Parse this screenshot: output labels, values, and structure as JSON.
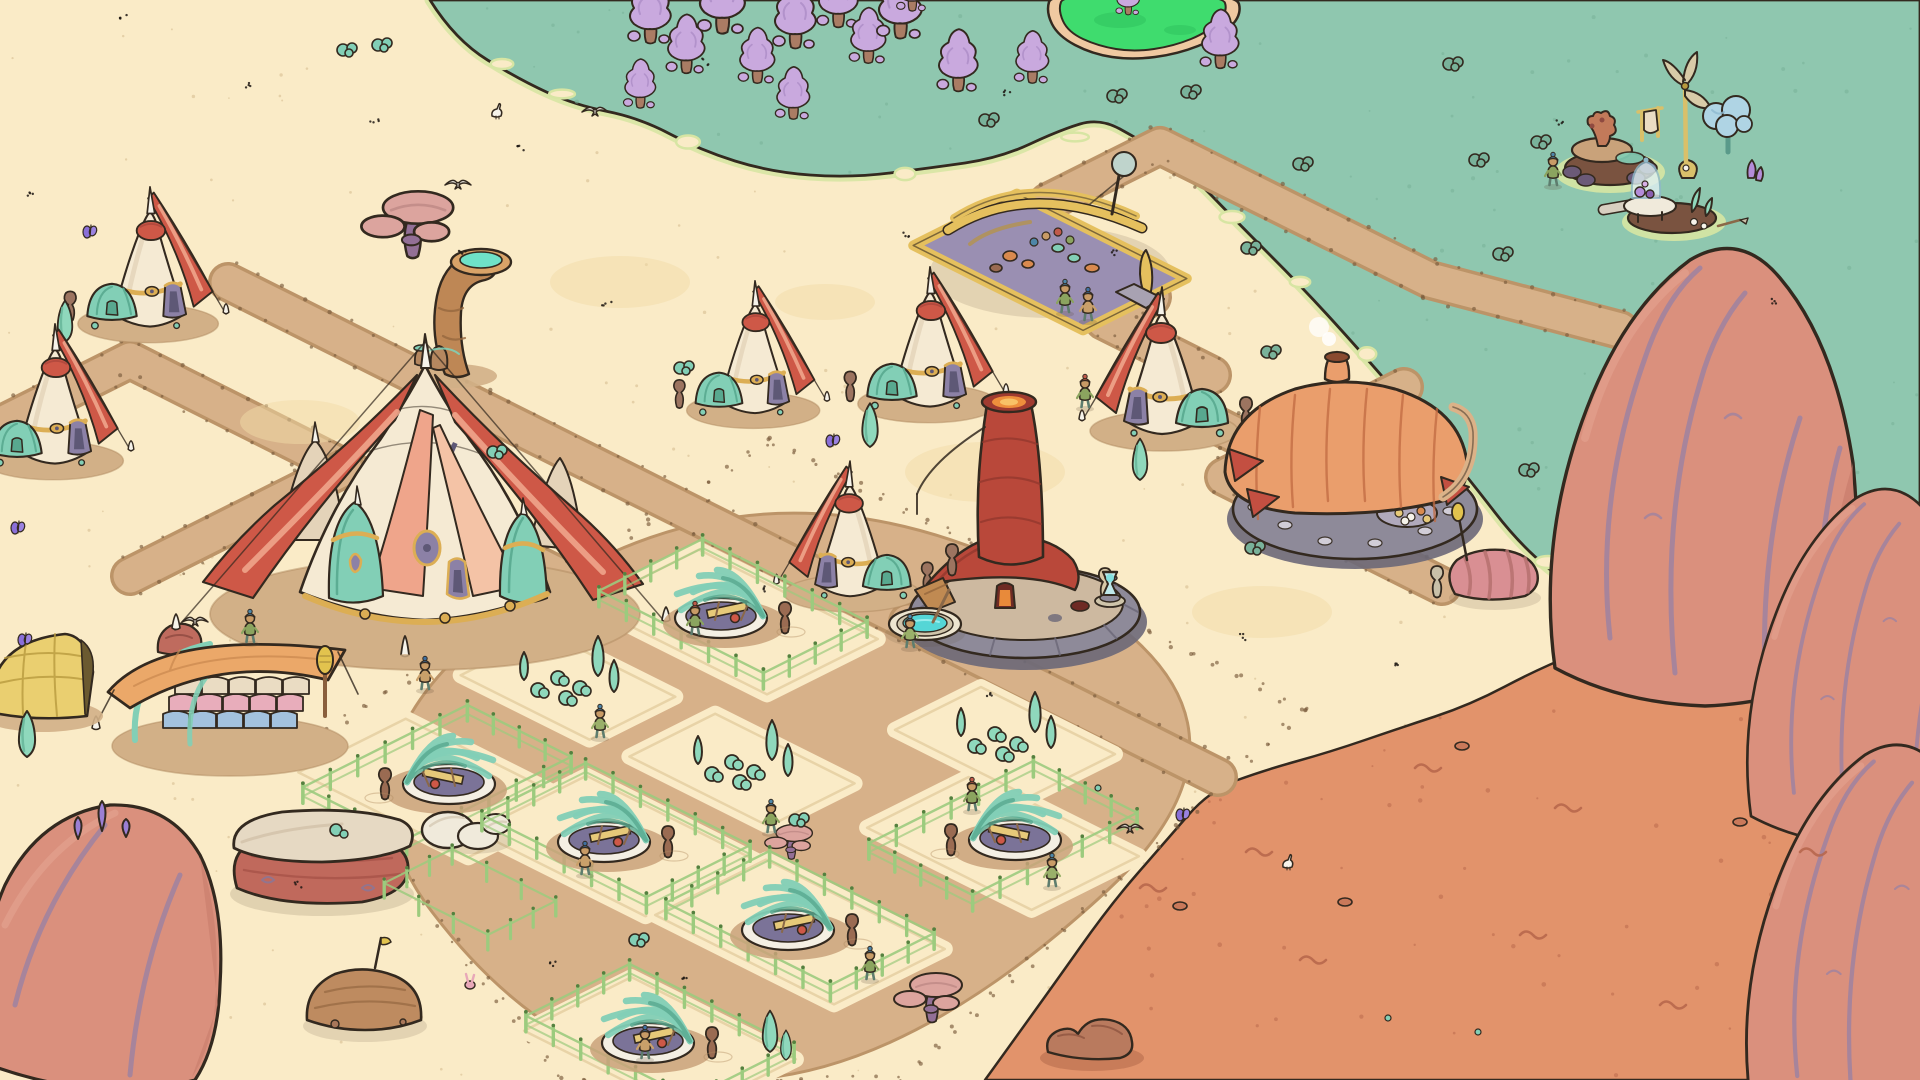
{
  "scene": {
    "type": "isometric-settlement-game-scene",
    "canvas": {
      "w": 1920,
      "h": 1080
    },
    "visible_text": []
  },
  "palette": {
    "outline": "#33291F",
    "sand": "#FAEBC7",
    "sandSpeck": "#DCC49A",
    "sandPatch": "#F1DCA8",
    "grass": "#8FC7AF",
    "grassDark": "#79B29A",
    "grassEdge": "#D7E5A3",
    "pondGreen": "#3FDC6E",
    "pondDark": "#2DBF5C",
    "pondRim": "#EFC9A1",
    "orange": "#E2936B",
    "orangeDark": "#B5654A",
    "road": "#D7B189",
    "roadEdge": "#BC9468",
    "roadDot": "#7A5A3C",
    "pad": "#FAEBC7",
    "padEdge": "#E3CD9F",
    "dirt": "#D2B087",
    "dirtDark": "#B08A5F",
    "cream": "#F5EAD3",
    "creamShade": "#E4D3B9",
    "red": "#CE5847",
    "redDark": "#A8453A",
    "salmon": "#EFA58B",
    "salmonLight": "#F4C3A6",
    "gold": "#DCAE54",
    "goldDark": "#B8893B",
    "purple": "#8C81A6",
    "purpleDark": "#5E5876",
    "teal": "#82CFB6",
    "tealDark": "#58A88F",
    "gourd": "#9C7460",
    "kilnRed": "#B9483A",
    "kilnDark": "#8F362C",
    "glow": "#EE8F3C",
    "glowCore": "#F8C267",
    "stone": "#8E8A99",
    "stoneDark": "#6C6878",
    "stoneTop": "#CDB9A0",
    "tan": "#DBB288",
    "flagRed": "#C34F41",
    "smoke": "#FFFFFF",
    "orangeBldg": "#EA9E6C",
    "orangeBldgDark": "#C06A42",
    "marketYellow": "#E5C05E",
    "marketYellowDark": "#B8933F",
    "marketFloor": "#9A8FB2",
    "pot": "#D98A4E",
    "tarp": "#EBA869",
    "tarpDark": "#C9884E",
    "balePink": "#E8ADBB",
    "baleBlue": "#A3C2DE",
    "baleCream": "#EADCC3",
    "bamboo": "#9CCB7E",
    "bambooDark": "#55803F",
    "basin": "#F4EFE3",
    "basinInner": "#7B7398",
    "plank": "#E6C979",
    "jar": "#9A6B52",
    "horn": "#BE8755",
    "hornDark": "#96683E",
    "water": "#6FE2C8",
    "poolWater": "#55D6D6",
    "poolStone": "#EDE5D0",
    "treePurple": "#C9A9DE",
    "treePurpleDark": "#AF8FC9",
    "trunk": "#AA7C64",
    "cypress": "#8FD8BC",
    "cypressDark": "#69B89B",
    "rockRed": "#DA907D",
    "rockRedDark": "#C47767",
    "rockHi": "#E5A693",
    "rockVein": "#9E82A0",
    "crystal": "#9B7FD4",
    "mesaTop": "#E6D9C3",
    "mesaBase": "#C0695C",
    "mesaStrata": "#A65348",
    "boulder": "#F0EADB",
    "boulderShade": "#D8CDB8",
    "mound": "#BE8B60",
    "moundStrata": "#9A6B45",
    "mushCap": "#DCA49E",
    "mushCapDark": "#BE8884",
    "mushStem": "#936F96",
    "blueTree": "#AFD4E4",
    "blueTreeDark": "#8FB9D0",
    "blueTreeTrunk": "#5A9A8A",
    "skin": "#C89B66",
    "shirtGreen": "#8BA45F",
    "shirtTan": "#C9A06A",
    "pants": "#5E7D6E",
    "wrapTeal": "#4E86A8",
    "wrapRed": "#C05A4A",
    "white": "#F6F3EA",
    "cocoonPink": "#D98F93",
    "cocoonDark": "#B5716F",
    "yellowCanopy": "#EACF70",
    "yellowCanopyDark": "#B89A3E",
    "glass": "#DFF0F2",
    "glassEdge": "#8FB9C9",
    "lampGlow": "#7FE0E0",
    "bunnyPink": "#E8A8B8"
  },
  "terrain": {
    "grass_boundary": [
      [
        430,
        0
      ],
      [
        455,
        40
      ],
      [
        520,
        80
      ],
      [
        575,
        105
      ],
      [
        640,
        118
      ],
      [
        700,
        150
      ],
      [
        770,
        172
      ],
      [
        850,
        178
      ],
      [
        930,
        168
      ],
      [
        1000,
        158
      ],
      [
        1060,
        130
      ],
      [
        1100,
        118
      ],
      [
        1140,
        140
      ],
      [
        1185,
        168
      ],
      [
        1240,
        225
      ],
      [
        1300,
        285
      ],
      [
        1355,
        345
      ],
      [
        1420,
        420
      ],
      [
        1470,
        480
      ],
      [
        1520,
        545
      ],
      [
        1575,
        590
      ],
      [
        1640,
        615
      ],
      [
        1720,
        632
      ],
      [
        1800,
        640
      ],
      [
        1920,
        648
      ]
    ],
    "orange_boundary": [
      [
        985,
        1080
      ],
      [
        1050,
        990
      ],
      [
        1110,
        905
      ],
      [
        1165,
        842
      ],
      [
        1210,
        790
      ],
      [
        1265,
        770
      ],
      [
        1330,
        752
      ],
      [
        1400,
        728
      ],
      [
        1470,
        705
      ],
      [
        1540,
        668
      ],
      [
        1610,
        640
      ],
      [
        1700,
        622
      ],
      [
        1800,
        612
      ],
      [
        1920,
        600
      ]
    ],
    "pond_outer": [
      [
        1046,
        12
      ],
      [
        1058,
        36
      ],
      [
        1092,
        54
      ],
      [
        1132,
        60
      ],
      [
        1178,
        54
      ],
      [
        1218,
        38
      ],
      [
        1242,
        16
      ],
      [
        1236,
        -8
      ],
      [
        1052,
        -8
      ]
    ],
    "pond_inner": [
      [
        1058,
        10
      ],
      [
        1068,
        32
      ],
      [
        1098,
        46
      ],
      [
        1134,
        52
      ],
      [
        1174,
        46
      ],
      [
        1208,
        32
      ],
      [
        1228,
        12
      ],
      [
        1222,
        -6
      ],
      [
        1064,
        -6
      ]
    ],
    "sand_pockets": [
      [
        502,
        64
      ],
      [
        562,
        94
      ],
      [
        688,
        142
      ],
      [
        905,
        174
      ],
      [
        1075,
        137
      ],
      [
        1232,
        217
      ],
      [
        1300,
        282
      ],
      [
        1367,
        354
      ],
      [
        1434,
        432
      ],
      [
        1548,
        562
      ]
    ],
    "roads": [
      {
        "pts": [
          [
            0,
            425
          ],
          [
            130,
            360
          ],
          [
            345,
            468
          ],
          [
            560,
            576
          ]
        ]
      },
      {
        "pts": [
          [
            228,
            282
          ],
          [
            480,
            408
          ],
          [
            700,
            518
          ],
          [
            908,
            622
          ]
        ]
      },
      {
        "pts": [
          [
            345,
            468
          ],
          [
            130,
            576
          ]
        ]
      },
      {
        "pts": [
          [
            1042,
            242
          ],
          [
            1152,
            297
          ],
          [
            1104,
            321
          ],
          [
            1212,
            375
          ],
          [
            1164,
            399
          ],
          [
            1272,
            453
          ],
          [
            1224,
            477
          ],
          [
            1332,
            531
          ]
        ]
      },
      {
        "pts": [
          [
            1272,
            453
          ],
          [
            1404,
            387
          ]
        ]
      },
      {
        "pts": [
          [
            1048,
            202
          ],
          [
            1160,
            146
          ],
          [
            1430,
            280
          ],
          [
            1620,
            330
          ]
        ]
      },
      {
        "pts": [
          [
            908,
            622
          ],
          [
            1218,
            777
          ]
        ]
      },
      {
        "pts": [
          [
            1332,
            531
          ],
          [
            1442,
            586
          ]
        ]
      }
    ],
    "district": [
      [
        770,
        442
      ],
      [
        1305,
        710
      ],
      [
        900,
        1080
      ],
      [
        560,
        1080
      ],
      [
        305,
        745
      ]
    ],
    "pads": [
      {
        "x": 733,
        "y": 622,
        "a": 100,
        "b": 62
      },
      {
        "x": 437,
        "y": 788,
        "a": 95,
        "b": 60
      },
      {
        "x": 616,
        "y": 846,
        "a": 95,
        "b": 62
      },
      {
        "x": 800,
        "y": 932,
        "a": 100,
        "b": 62
      },
      {
        "x": 1003,
        "y": 842,
        "a": 92,
        "b": 60
      },
      {
        "x": 660,
        "y": 1045,
        "a": 92,
        "b": 60
      },
      {
        "x": 568,
        "y": 686,
        "a": 72,
        "b": 48
      },
      {
        "x": 742,
        "y": 770,
        "a": 78,
        "b": 48
      },
      {
        "x": 1005,
        "y": 742,
        "a": 75,
        "b": 48
      }
    ]
  },
  "entities": [
    {
      "t": "tp",
      "x": 650,
      "y": 42,
      "s": 1
    },
    {
      "t": "tp",
      "x": 686,
      "y": 72,
      "s": 0.9
    },
    {
      "t": "tp",
      "x": 722,
      "y": 32,
      "s": 1.1
    },
    {
      "t": "tp",
      "x": 757,
      "y": 82,
      "s": 0.85
    },
    {
      "t": "tp",
      "x": 795,
      "y": 47,
      "s": 1
    },
    {
      "t": "tp",
      "x": 838,
      "y": 26,
      "s": 0.95
    },
    {
      "t": "tp",
      "x": 868,
      "y": 62,
      "s": 0.85
    },
    {
      "t": "tp",
      "x": 900,
      "y": 37,
      "s": 1.05
    },
    {
      "t": "tp",
      "x": 793,
      "y": 118,
      "s": 0.8
    },
    {
      "t": "tp",
      "x": 640,
      "y": 107,
      "s": 0.75
    },
    {
      "t": "tp",
      "x": 958,
      "y": 90,
      "s": 0.95
    },
    {
      "t": "tp",
      "x": 1032,
      "y": 82,
      "s": 0.8
    },
    {
      "t": "tp",
      "x": 1220,
      "y": 67,
      "s": 0.9
    },
    {
      "t": "tp",
      "x": 912,
      "y": 10,
      "s": 0.7
    },
    {
      "t": "tp",
      "x": 1128,
      "y": 14,
      "s": 0.55
    },
    {
      "t": "bu",
      "x": 1192,
      "y": 92
    },
    {
      "t": "bu",
      "x": 1304,
      "y": 164
    },
    {
      "t": "bu",
      "x": 1454,
      "y": 64
    },
    {
      "t": "bu",
      "x": 1504,
      "y": 254
    },
    {
      "t": "bu",
      "x": 1530,
      "y": 470
    },
    {
      "t": "bu",
      "x": 1252,
      "y": 248
    },
    {
      "t": "bu",
      "x": 1338,
      "y": 432
    },
    {
      "t": "bu",
      "x": 1542,
      "y": 142
    },
    {
      "t": "bu",
      "x": 1480,
      "y": 160
    },
    {
      "t": "bu",
      "x": 1118,
      "y": 96
    },
    {
      "t": "bu",
      "x": 1272,
      "y": 352
    },
    {
      "t": "bu",
      "x": 990,
      "y": 120
    },
    {
      "t": "isl",
      "x": 0,
      "y": 0
    },
    {
      "t": "sp",
      "x": 620,
      "y": 282,
      "a": 70,
      "b": 26
    },
    {
      "t": "sp",
      "x": 985,
      "y": 472,
      "a": 80,
      "b": 30
    },
    {
      "t": "sp",
      "x": 300,
      "y": 422,
      "a": 60,
      "b": 22
    },
    {
      "t": "sp",
      "x": 1262,
      "y": 612,
      "a": 70,
      "b": 26
    },
    {
      "t": "sp",
      "x": 825,
      "y": 302,
      "a": 50,
      "b": 18
    },
    {
      "t": "mu",
      "x": 410,
      "y": 248,
      "s": 1.35
    },
    {
      "t": "te",
      "x": 150,
      "y": 318,
      "s": 0.95
    },
    {
      "t": "mk",
      "x": 1050,
      "y": 262
    },
    {
      "t": "ho",
      "x": 455,
      "y": 306
    },
    {
      "t": "vi",
      "x": 1065,
      "y": 312,
      "v": 0
    },
    {
      "t": "vi",
      "x": 1088,
      "y": 320,
      "v": 1
    },
    {
      "t": "te",
      "x": 930,
      "y": 398,
      "s": 0.95
    },
    {
      "t": "te",
      "x": 755,
      "y": 405,
      "s": 0.9
    },
    {
      "t": "cy",
      "x": 65,
      "y": 342,
      "s": 0.9
    },
    {
      "t": "te",
      "x": 1162,
      "y": 425,
      "s": 1,
      "fl": true
    },
    {
      "t": "vi",
      "x": 1085,
      "y": 407,
      "v": 2
    },
    {
      "t": "te",
      "x": 55,
      "y": 455,
      "s": 0.95
    },
    {
      "t": "st",
      "x": 235,
      "y": 568
    },
    {
      "t": "sr",
      "x": 180,
      "y": 642
    },
    {
      "t": "bt",
      "x": 425,
      "y": 600
    },
    {
      "t": "te",
      "x": 850,
      "y": 588,
      "s": 0.92,
      "fl": true
    },
    {
      "t": "ki",
      "x": 1025,
      "y": 612
    },
    {
      "t": "ju",
      "x": 958,
      "y": 574
    },
    {
      "t": "po",
      "x": 925,
      "y": 624
    },
    {
      "t": "vi",
      "x": 910,
      "y": 647,
      "v": 3
    },
    {
      "t": "la",
      "x": 1110,
      "y": 597
    },
    {
      "t": "ob",
      "x": 1355,
      "y": 507
    },
    {
      "t": "bu",
      "x": 1256,
      "y": 548
    },
    {
      "t": "cc",
      "x": 1470,
      "y": 572
    },
    {
      "t": "co",
      "x": 1495,
      "y": 580
    },
    {
      "t": "cy",
      "x": 870,
      "y": 447,
      "s": 0.95
    },
    {
      "t": "cy",
      "x": 1140,
      "y": 480,
      "s": 0.9
    },
    {
      "t": "st",
      "x": 405,
      "y": 655
    },
    {
      "t": "sc",
      "x": 230,
      "y": 720
    },
    {
      "t": "vi",
      "x": 250,
      "y": 642,
      "v": 0
    },
    {
      "t": "vi",
      "x": 425,
      "y": 689,
      "v": 1
    },
    {
      "t": "yc",
      "x": 35,
      "y": 702
    },
    {
      "t": "fa",
      "x": 733,
      "y": 622
    },
    {
      "t": "vi",
      "x": 695,
      "y": 634,
      "v": 2,
      "p": 1
    },
    {
      "t": "nu",
      "x": 568,
      "y": 686
    },
    {
      "t": "nu",
      "x": 1005,
      "y": 742
    },
    {
      "t": "nu",
      "x": 742,
      "y": 770
    },
    {
      "t": "fa",
      "x": 437,
      "y": 788,
      "fl": true
    },
    {
      "t": "vi",
      "x": 600,
      "y": 737,
      "v": 3
    },
    {
      "t": "cy",
      "x": 27,
      "y": 757,
      "s": 1
    },
    {
      "t": "mu",
      "x": 790,
      "y": 854,
      "s": 0.7
    },
    {
      "t": "vi",
      "x": 771,
      "y": 832,
      "v": 0
    },
    {
      "t": "me",
      "x": 322,
      "y": 850
    },
    {
      "t": "bo",
      "x": 468,
      "y": 830
    },
    {
      "t": "fa",
      "x": 616,
      "y": 846
    },
    {
      "t": "vi",
      "x": 585,
      "y": 874,
      "v": 1,
      "p": 1
    },
    {
      "t": "fa",
      "x": 1003,
      "y": 844,
      "fl": true
    },
    {
      "t": "vi",
      "x": 972,
      "y": 810,
      "v": 2,
      "p": 1
    },
    {
      "t": "vi",
      "x": 1052,
      "y": 886,
      "v": 3
    },
    {
      "t": "fa",
      "x": 800,
      "y": 934
    },
    {
      "t": "fe",
      "x": 470,
      "y": 907
    },
    {
      "t": "vi",
      "x": 870,
      "y": 979,
      "v": 0
    },
    {
      "t": "mo",
      "x": 365,
      "y": 1014
    },
    {
      "t": "mu",
      "x": 930,
      "y": 1015,
      "s": 1
    },
    {
      "t": "rc",
      "x": 1092,
      "y": 1042
    },
    {
      "t": "fa",
      "x": 660,
      "y": 1047
    },
    {
      "t": "vi",
      "x": 645,
      "y": 1058,
      "v": 1,
      "p": 1
    },
    {
      "t": "bl",
      "x": 100,
      "y": 945,
      "v": 4,
      "s": 1
    },
    {
      "t": "bl",
      "x": 1705,
      "y": 478,
      "v": 1,
      "s": 1
    },
    {
      "t": "bl",
      "x": 1868,
      "y": 668,
      "v": 2,
      "s": 0.78
    },
    {
      "t": "bl",
      "x": 1878,
      "y": 940,
      "v": 3,
      "s": 0.85
    },
    {
      "t": "cy",
      "x": 770,
      "y": 1052,
      "s": 0.9
    },
    {
      "t": "cy",
      "x": 786,
      "y": 1060,
      "s": 0.65
    },
    {
      "t": "bu",
      "x": 348,
      "y": 50,
      "sand": true
    },
    {
      "t": "bu",
      "x": 383,
      "y": 45,
      "sand": true
    },
    {
      "t": "bu",
      "x": 685,
      "y": 368,
      "sand": true
    },
    {
      "t": "bu",
      "x": 800,
      "y": 820,
      "sand": true
    },
    {
      "t": "bu",
      "x": 640,
      "y": 940,
      "sand": true
    },
    {
      "t": "bu",
      "x": 498,
      "y": 452,
      "sand": true
    },
    {
      "t": "sq",
      "x": 1140,
      "y": 888
    },
    {
      "t": "sq",
      "x": 1246,
      "y": 852
    },
    {
      "t": "sq",
      "x": 1415,
      "y": 768
    },
    {
      "t": "sq",
      "x": 1555,
      "y": 808
    },
    {
      "t": "sq",
      "x": 1300,
      "y": 960
    },
    {
      "t": "sq",
      "x": 1520,
      "y": 935
    },
    {
      "t": "sq",
      "x": 1660,
      "y": 1005
    },
    {
      "t": "sq",
      "x": 1800,
      "y": 852
    },
    {
      "t": "pe",
      "x": 1180,
      "y": 906
    },
    {
      "t": "pe",
      "x": 1462,
      "y": 746
    },
    {
      "t": "pe",
      "x": 1740,
      "y": 822
    },
    {
      "t": "pe",
      "x": 1345,
      "y": 902
    },
    {
      "t": "td",
      "x": 1478,
      "y": 1032
    },
    {
      "t": "td",
      "x": 1388,
      "y": 1018
    },
    {
      "t": "td",
      "x": 1098,
      "y": 788
    },
    {
      "t": "bn",
      "x": 470,
      "y": 985
    },
    {
      "t": "vi",
      "x": 1553,
      "y": 185,
      "v": 0
    },
    {
      "t": "bi",
      "x": 595,
      "y": 112,
      "fly": true
    },
    {
      "t": "bi",
      "x": 458,
      "y": 185,
      "fly": true
    },
    {
      "t": "bi",
      "x": 195,
      "y": 622,
      "fly": true
    },
    {
      "t": "bi",
      "x": 1130,
      "y": 829,
      "fly": true
    },
    {
      "t": "bi",
      "x": 497,
      "y": 116
    },
    {
      "t": "bi",
      "x": 1288,
      "y": 867
    },
    {
      "t": "bf",
      "x": 90,
      "y": 234
    },
    {
      "t": "bf",
      "x": 833,
      "y": 443
    },
    {
      "t": "bf",
      "x": 25,
      "y": 642
    },
    {
      "t": "bf",
      "x": 1183,
      "y": 817
    },
    {
      "t": "bf",
      "x": 18,
      "y": 530
    },
    {
      "t": "fl",
      "x": 123,
      "y": 18
    },
    {
      "t": "fl",
      "x": 247,
      "y": 84
    },
    {
      "t": "fl",
      "x": 32,
      "y": 194
    },
    {
      "t": "fl",
      "x": 375,
      "y": 122
    },
    {
      "t": "fl",
      "x": 520,
      "y": 148
    },
    {
      "t": "fl",
      "x": 705,
      "y": 62
    },
    {
      "t": "fl",
      "x": 905,
      "y": 234
    },
    {
      "t": "fl",
      "x": 1008,
      "y": 94
    },
    {
      "t": "fl",
      "x": 462,
      "y": 252
    },
    {
      "t": "fl",
      "x": 607,
      "y": 304
    },
    {
      "t": "fl",
      "x": 1112,
      "y": 252
    },
    {
      "t": "fl",
      "x": 762,
      "y": 588
    },
    {
      "t": "fl",
      "x": 990,
      "y": 694
    },
    {
      "t": "fl",
      "x": 554,
      "y": 964
    },
    {
      "t": "fl",
      "x": 1242,
      "y": 637
    },
    {
      "t": "fl",
      "x": 1398,
      "y": 662
    },
    {
      "t": "fl",
      "x": 1558,
      "y": 124
    },
    {
      "t": "fl",
      "x": 1772,
      "y": 300
    },
    {
      "t": "fl",
      "x": 684,
      "y": 978
    },
    {
      "t": "fl",
      "x": 298,
      "y": 884
    }
  ]
}
